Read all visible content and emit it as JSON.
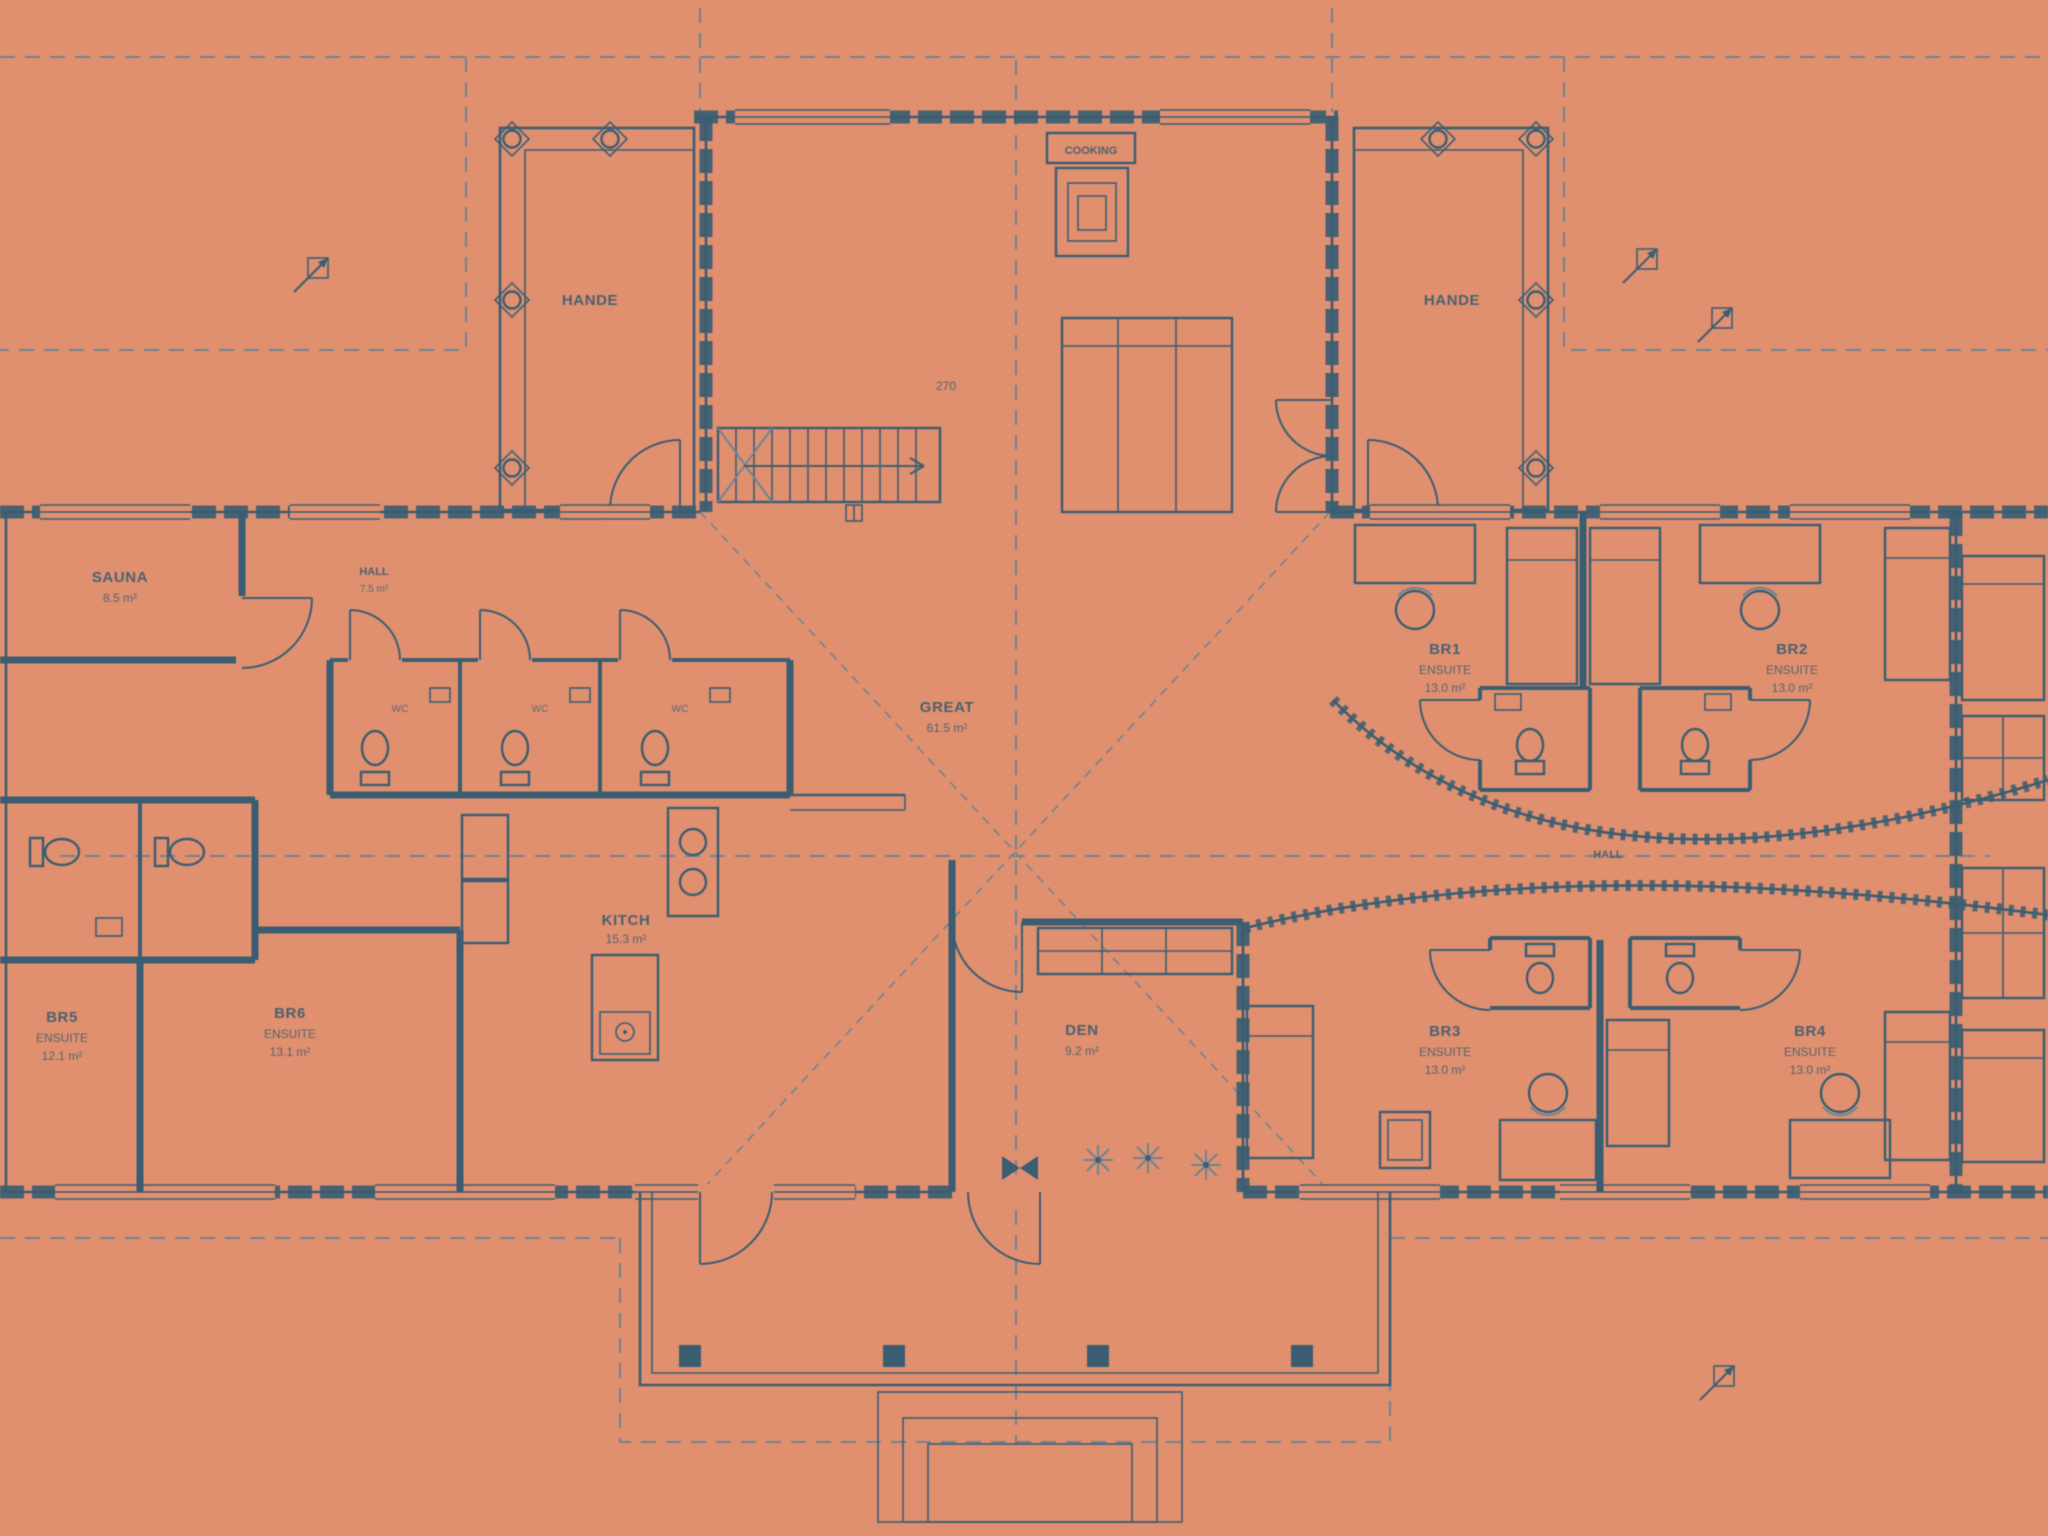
{
  "colors": {
    "background": "#e0906f",
    "ink": "#3a5d72",
    "ink_soft": "#6c8494"
  },
  "labels": {
    "lanai_left": "HANDE",
    "lanai_right": "HANDE",
    "hearth": "COOKING",
    "stair_rise": "270",
    "great": {
      "name": "GREAT",
      "area": "61.5 m²"
    },
    "sauna": {
      "name": "SAUNA",
      "area": "8.5 m²"
    },
    "hall_left": {
      "name": "HALL",
      "area": "7.5 m²"
    },
    "kitchen": {
      "name": "KITCH",
      "area": "15.3 m²"
    },
    "den": {
      "name": "DEN",
      "area": "9.2 m²"
    },
    "hall_right": "HALL",
    "wc": [
      "WC",
      "WC",
      "WC"
    ],
    "br1": {
      "name": "BR1",
      "suffix": "ENSUITE",
      "area": "13.0 m²"
    },
    "br2": {
      "name": "BR2",
      "suffix": "ENSUITE",
      "area": "13.0 m²"
    },
    "br3": {
      "name": "BR3",
      "suffix": "ENSUITE",
      "area": "13.0 m²"
    },
    "br4": {
      "name": "BR4",
      "suffix": "ENSUITE",
      "area": "13.0 m²"
    },
    "br5": {
      "name": "BR5",
      "suffix": "ENSUITE",
      "area": "12.1 m²"
    },
    "br6": {
      "name": "BR6",
      "suffix": "ENSUITE",
      "area": "13.1 m²"
    }
  }
}
